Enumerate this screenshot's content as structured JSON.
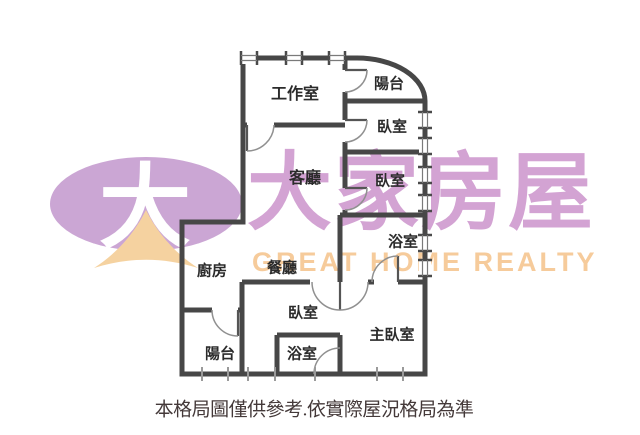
{
  "watermark": {
    "logo_symbol": "大",
    "brand_name_zh": "大家房屋",
    "brand_name_en": "GREAT HOME REALTY",
    "colors": {
      "logo_ellipse": "#CBA6D4",
      "logo_roof": "#F5D2A0",
      "brand_text_zh": "#D3A3D3",
      "brand_text_en": "#F6CB9B"
    }
  },
  "floor_plan": {
    "wall_color": "#474747",
    "rooms": [
      {
        "id": "workroom",
        "label": "工作室"
      },
      {
        "id": "balcony-top",
        "label": "陽台"
      },
      {
        "id": "bedroom-1",
        "label": "臥室"
      },
      {
        "id": "living-room",
        "label": "客廳"
      },
      {
        "id": "bedroom-2",
        "label": "臥室"
      },
      {
        "id": "bathroom-upper",
        "label": "浴室"
      },
      {
        "id": "kitchen",
        "label": "廚房"
      },
      {
        "id": "dining-room",
        "label": "餐廳"
      },
      {
        "id": "bedroom-3",
        "label": "臥室"
      },
      {
        "id": "master-bedroom",
        "label": "主臥室"
      },
      {
        "id": "bathroom-lower",
        "label": "浴室"
      },
      {
        "id": "balcony-bottom",
        "label": "陽台"
      }
    ],
    "caption": "本格局圖僅供參考.依實際屋況格局為準"
  }
}
